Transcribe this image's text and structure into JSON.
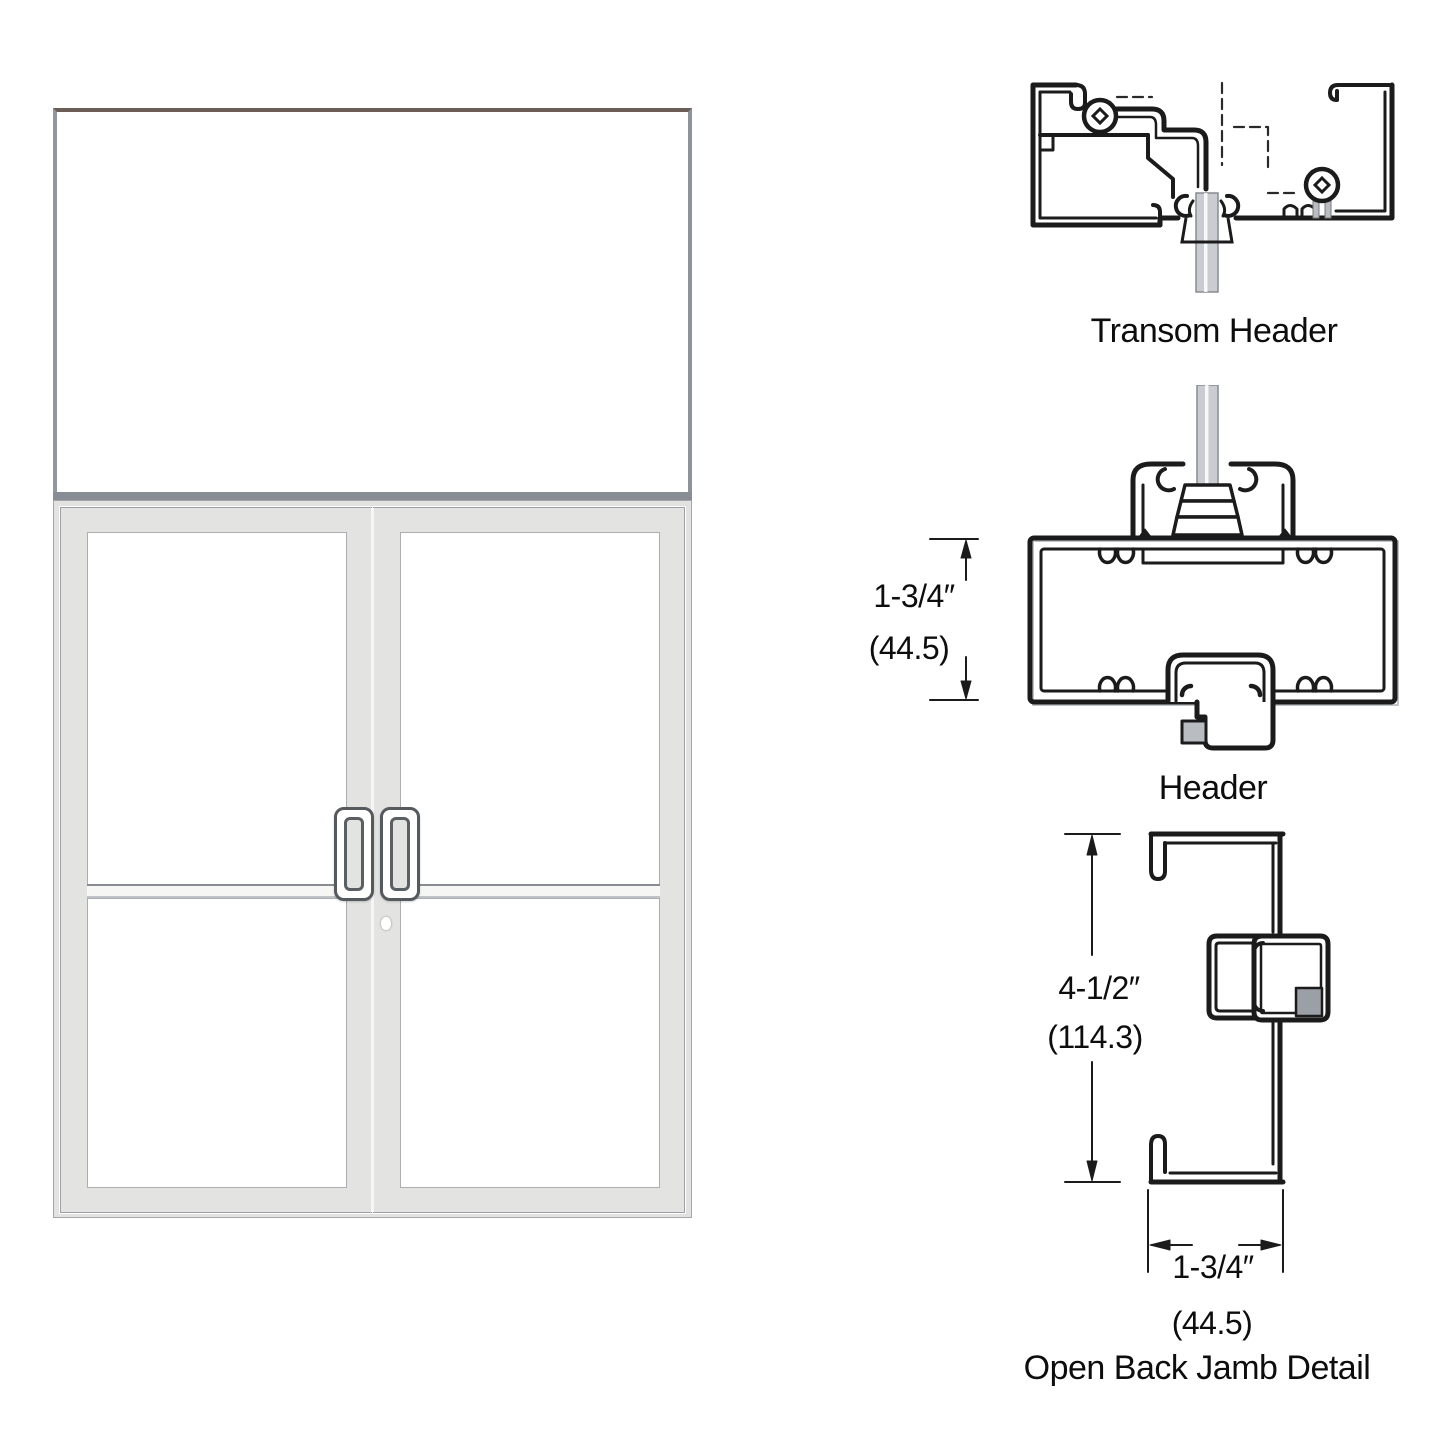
{
  "page": {
    "background": "#ffffff"
  },
  "elevation": {
    "description": "Double aluminum storefront door with transom, narrow stile, pair of offset pull handles, mid rails and lock cylinder on active leaf"
  },
  "details": {
    "transom_header": {
      "label": "Transom Header"
    },
    "header": {
      "label": "Header",
      "dims": {
        "inches": "1-3/4″",
        "mm": "(44.5)"
      }
    },
    "open_back_jamb": {
      "label": "Open Back Jamb Detail",
      "dims": {
        "height_inches": "4-1/2″",
        "height_mm": "(114.3)",
        "width_inches": "1-3/4″",
        "width_mm": "(44.5)"
      }
    }
  },
  "colors": {
    "line": "#1b1b1b",
    "frame_gray": "#e2e2e1",
    "edge_gray": "#9aa0a6",
    "glass_stem_gray": "#c9ccd0",
    "transom_top_edge": "#6b5e57"
  }
}
